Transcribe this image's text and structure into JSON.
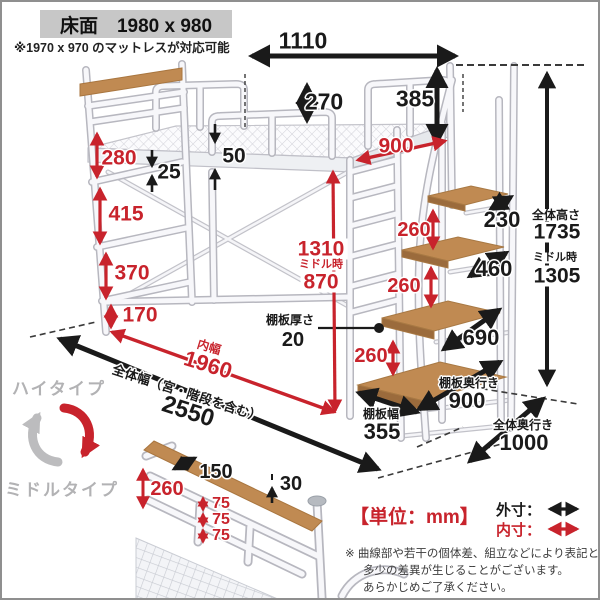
{
  "header": {
    "floor_label": "床面　1980 x 980",
    "mattress_note": "※1970 x 970 のマットレスが対応可能"
  },
  "colors": {
    "accent_red": "#c8232c",
    "black": "#1a1a1a",
    "gray_text": "#b2b2b4",
    "wood": "#c08a52",
    "header_bg": "#c7c7c7"
  },
  "dims": {
    "entry_width": "1110",
    "guard_rail_height": "270",
    "stair_rail_height": "385",
    "bed_depth": "900",
    "deck_thickness": "50",
    "mesh_inset": "25",
    "ladder_gap_1": "280",
    "ladder_gap_2": "415",
    "ladder_gap_3": "370",
    "ladder_gap_4": "170",
    "under_height_high": "1310",
    "middle_time_label": "ミドル時",
    "under_height_middle": "870",
    "step_gap_1": "260",
    "step_gap_2": "260",
    "step_gap_3": "260",
    "shelf_thickness_label": "棚板厚さ",
    "shelf_thickness": "20",
    "step_depth_1": "230",
    "step_depth_2": "460",
    "step_depth_3": "690",
    "shelf_depth_label": "棚板奥行き",
    "shelf_depth": "900",
    "shelf_width_label": "棚板幅",
    "shelf_width": "355",
    "overall_height_label": "全体高さ",
    "overall_height": "1735",
    "overall_height_mid_label": "ミドル時",
    "overall_height_mid": "1305",
    "inner_width_label": "内幅",
    "inner_width": "1960",
    "overall_width_label": "全体幅（宮・階段を含む）",
    "overall_width": "2550",
    "overall_depth_label": "全体奥行き",
    "overall_depth": "1000"
  },
  "types": {
    "high": "ハイタイプ",
    "middle": "ミドルタイプ"
  },
  "detail": {
    "shelf_grip": "150",
    "top_gap": "30",
    "headboard_height": "260",
    "rail_gaps": [
      "75",
      "75",
      "75"
    ]
  },
  "legend": {
    "unit": "【単位：mm】",
    "outer": "外寸：",
    "inner": "内寸：",
    "note1": "※ 曲線部や若干の個体差、組立などにより表記と",
    "note2": "多少の差異が生じることがございます。",
    "note3": "あらかじめご了承ください。"
  }
}
